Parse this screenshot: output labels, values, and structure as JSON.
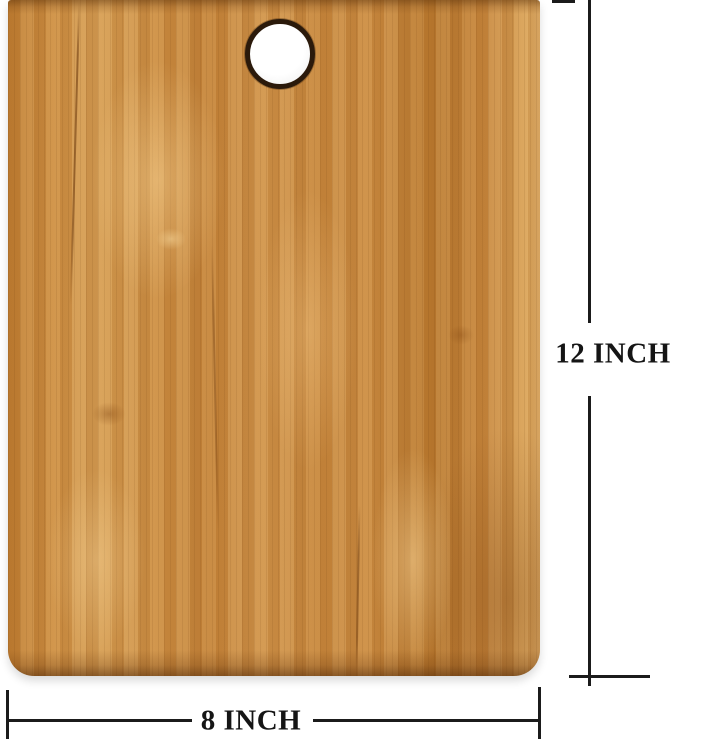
{
  "dimensions": {
    "height": {
      "label": "12 INCH"
    },
    "width": {
      "label": "8 INCH"
    },
    "line_color": "#1b1b1b",
    "label_color": "#151515"
  },
  "board": {
    "wood_base_color": "#c8873e",
    "wood_light_color": "#d9a258",
    "wood_dark_color": "#ba7a30",
    "hole_ring_color": "#2b1a0b",
    "hole_fill_color": "#ffffff"
  },
  "background_color": "#ffffff"
}
